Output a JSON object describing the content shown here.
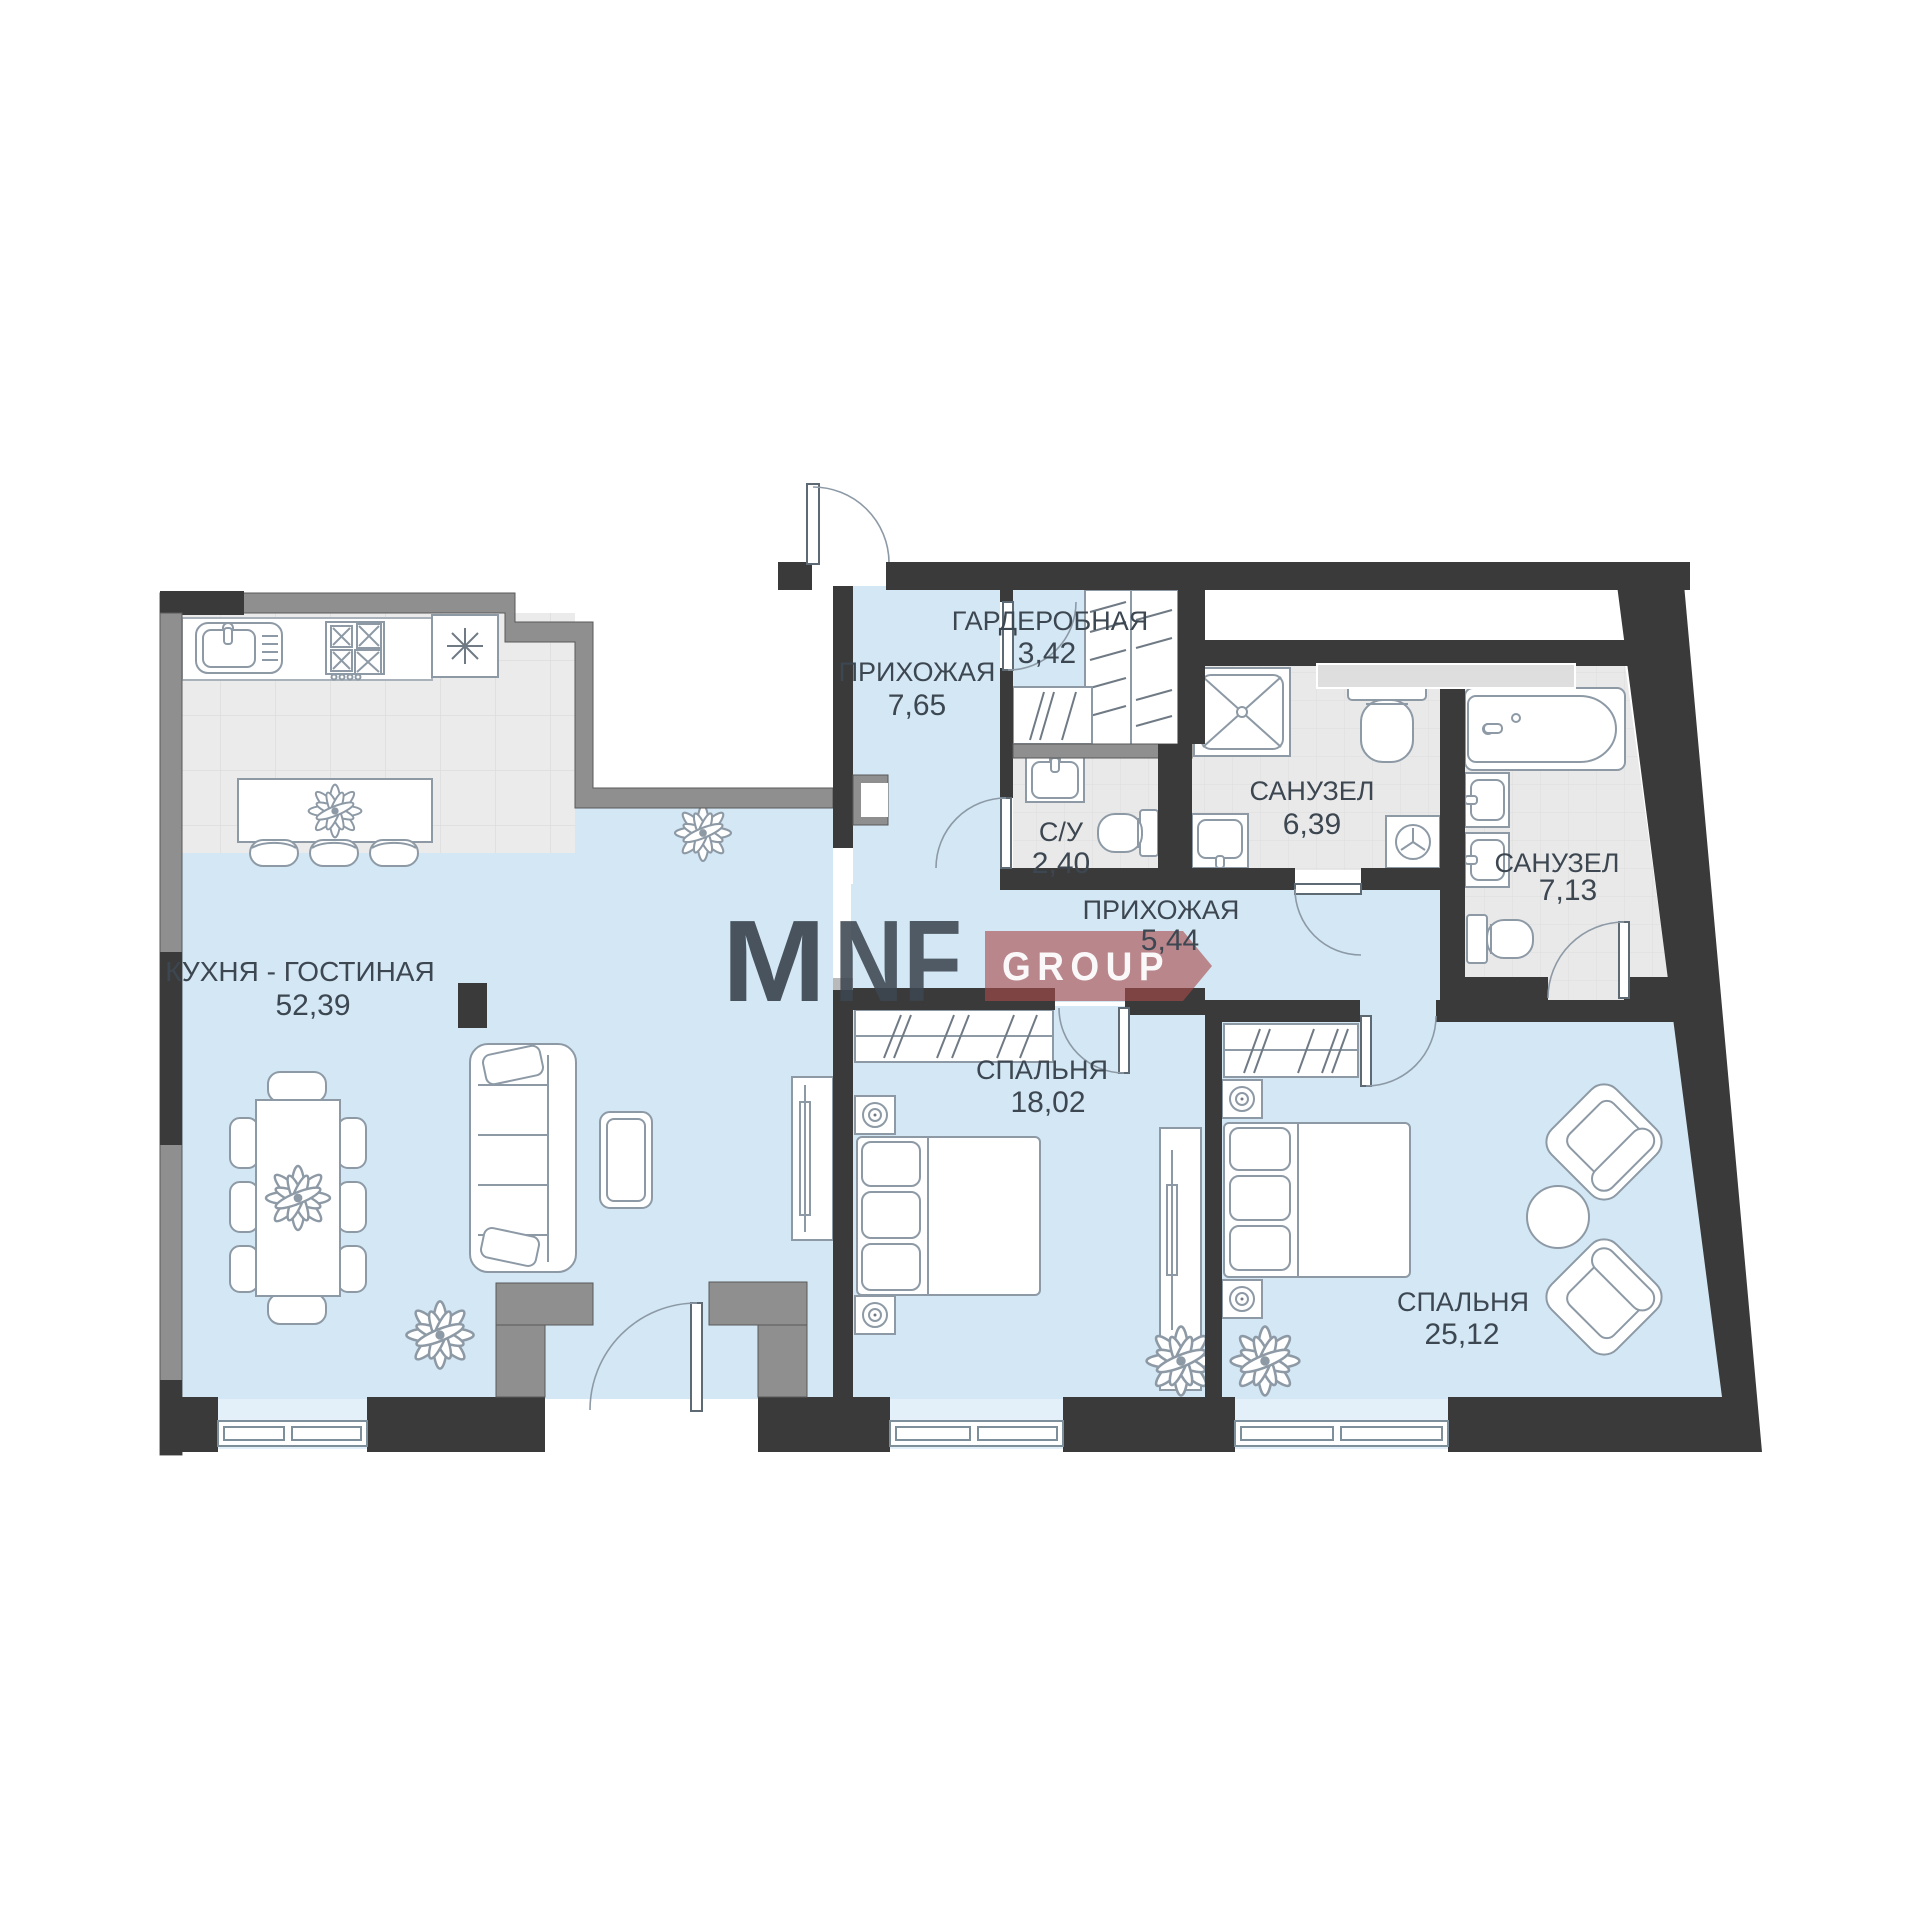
{
  "floorplan": {
    "title": "apartment-floor-plan",
    "rooms": [
      {
        "name": "КУХНЯ - ГОСТИНАЯ",
        "area": "52,39"
      },
      {
        "name": "ПРИХОЖАЯ",
        "area": "7,65"
      },
      {
        "name": "ГАРДЕРОБНАЯ",
        "area": "3,42"
      },
      {
        "name": "С/У",
        "area": "2,40"
      },
      {
        "name": "САНУЗЕЛ",
        "area": "6,39"
      },
      {
        "name": "САНУЗЕЛ",
        "area": "7,13"
      },
      {
        "name": "ПРИХОЖАЯ",
        "area": "5,44"
      },
      {
        "name": "СПАЛЬНЯ",
        "area": "18,02"
      },
      {
        "name": "СПАЛЬНЯ",
        "area": "25,12"
      }
    ],
    "logo": {
      "m": "M",
      "brand": "NF",
      "group": "GROUP"
    },
    "colors": {
      "wall_dark": "#3a3a3a",
      "wall_gray": "#8f8f8f",
      "floor_blue": "#d3e7f4",
      "floor_tile": "#ebebeb",
      "logo_pink": "#c897a6",
      "logo_red": "#a84a4a",
      "label_text": "#3d4751"
    }
  }
}
